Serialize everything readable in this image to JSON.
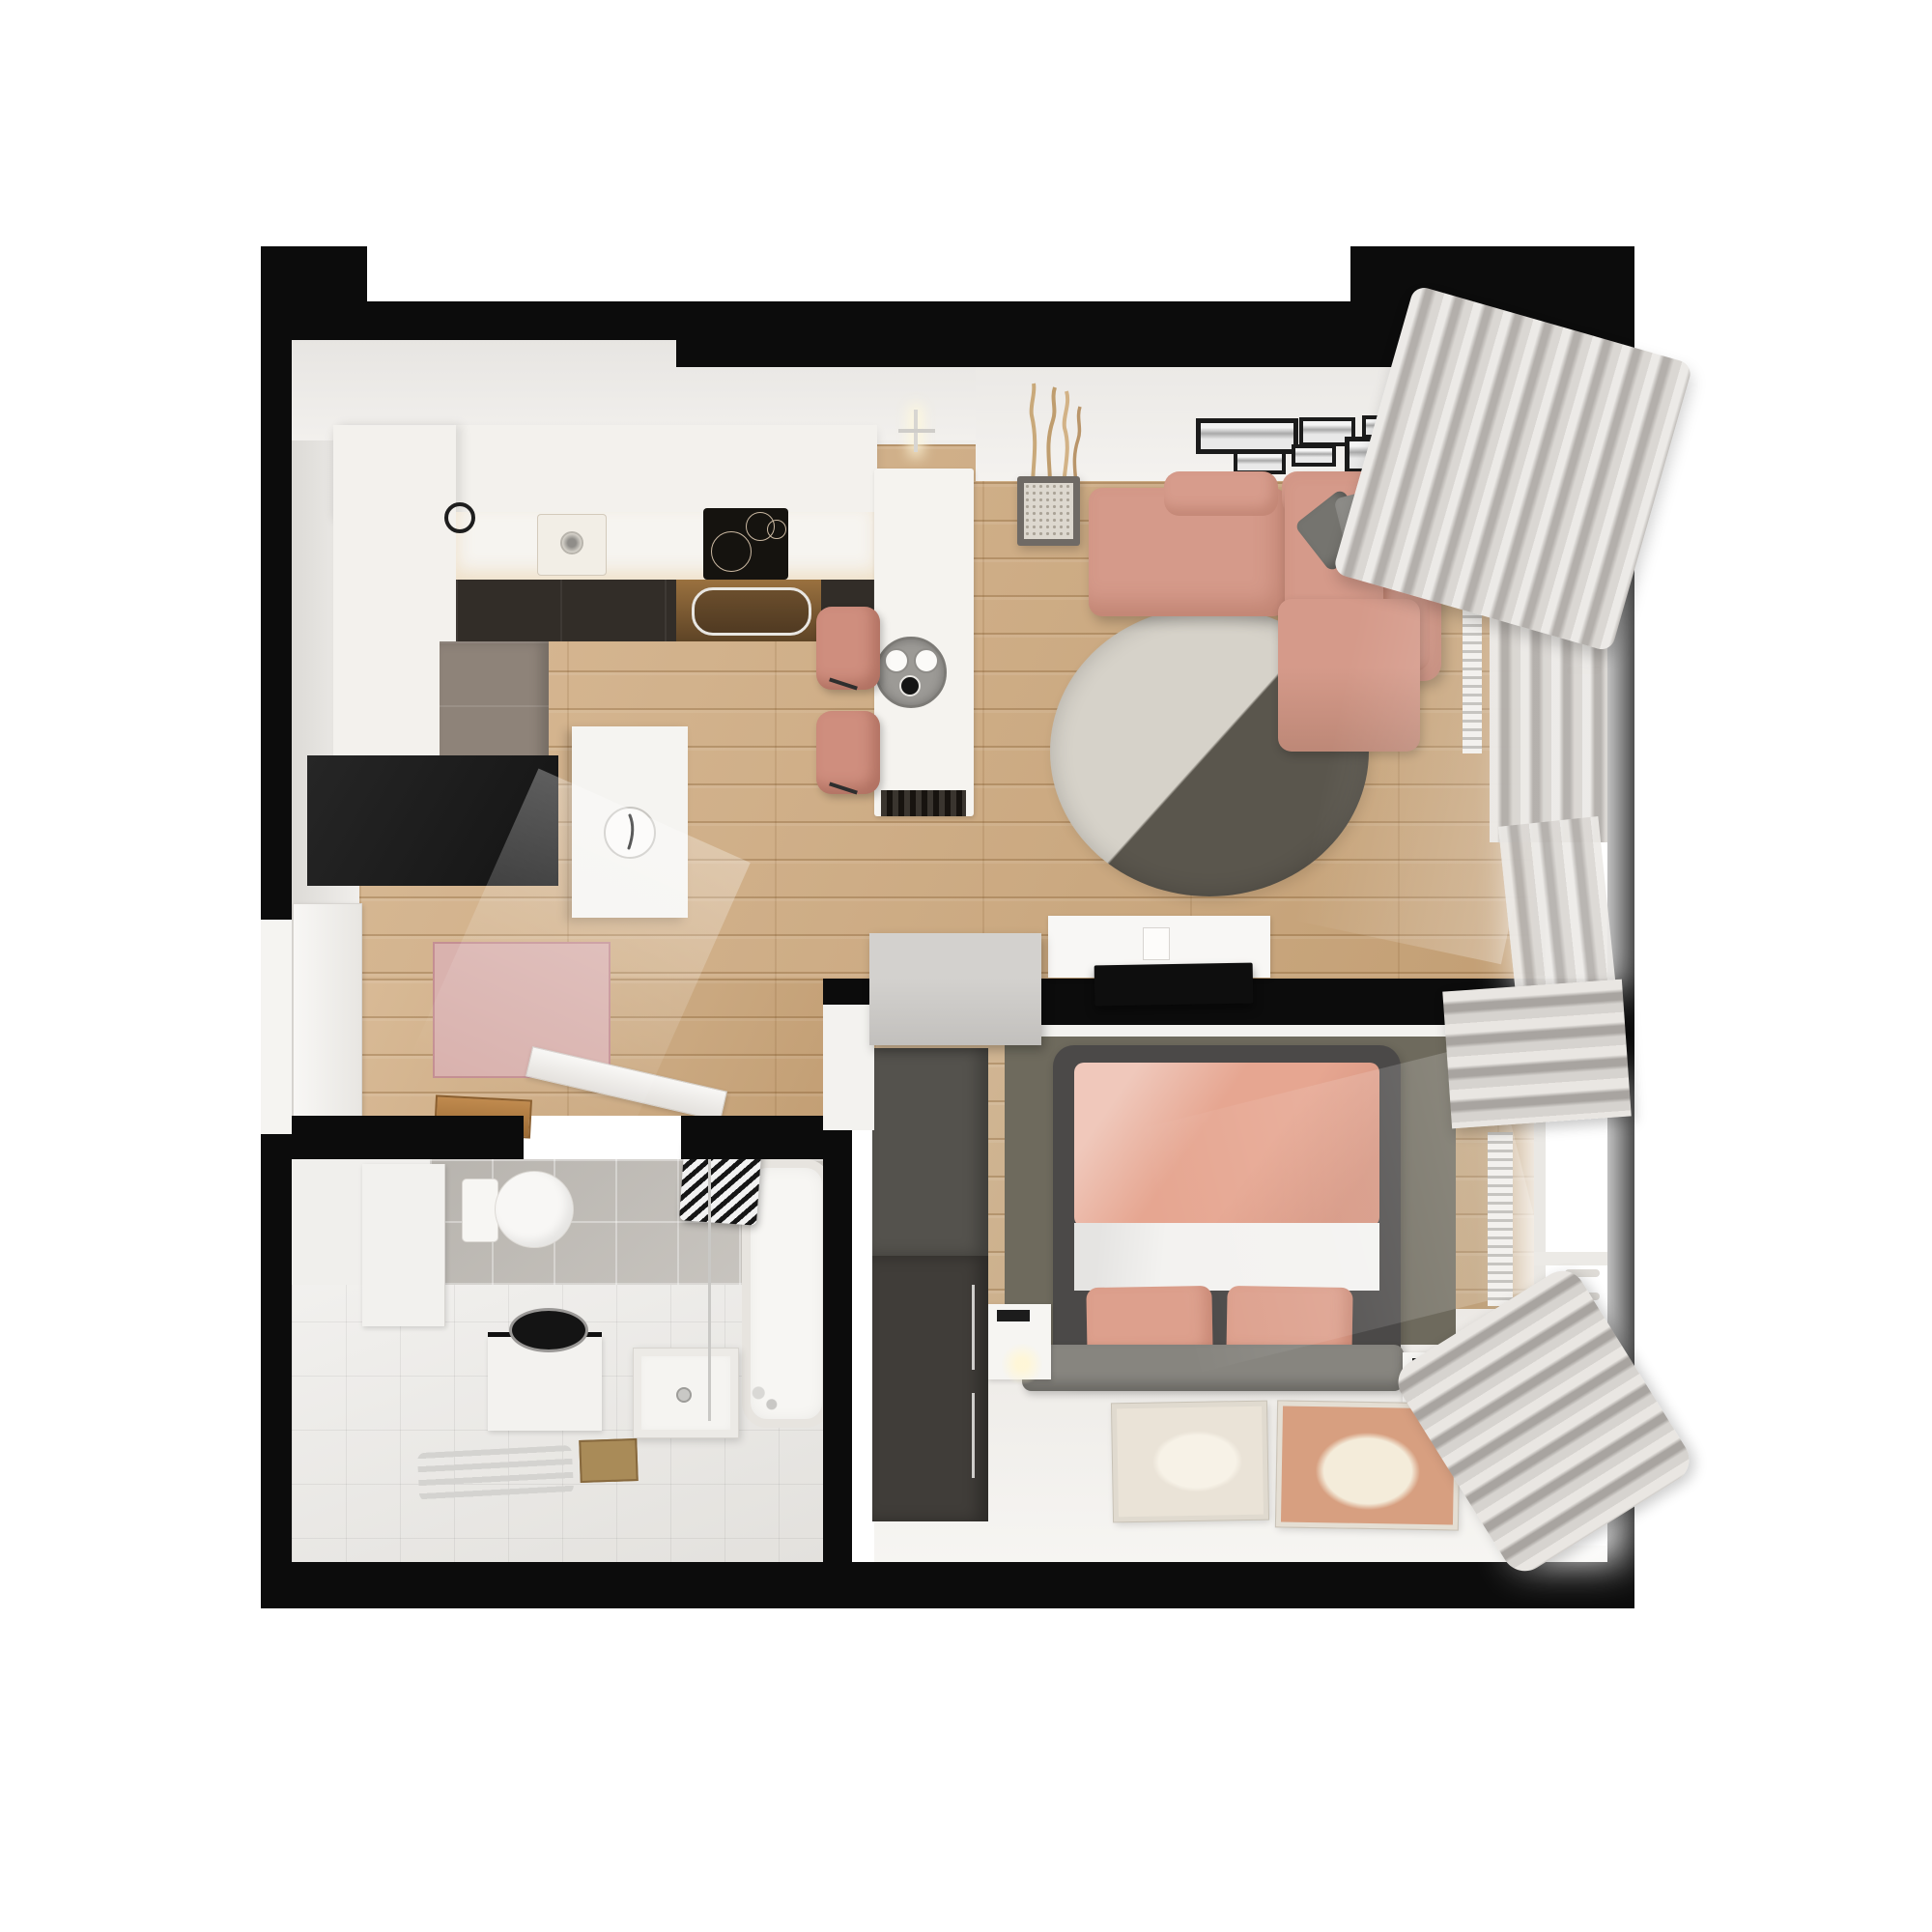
{
  "scene": {
    "type": "3d-rendered-floor-plan-top-view",
    "subject": "small one-bedroom apartment interior, photoreal top-down render",
    "background": "#ffffff",
    "no_visible_text": true
  },
  "palette": {
    "wall_black": "#0c0c0c",
    "inner_wall_white": "#efedea",
    "wood_floor": "#cfa97c",
    "wood_floor_bedroom": "#c9a87e",
    "counter_white": "#f6f4f0",
    "cabinet_white": "#f3f1ed",
    "cabinet_dark": "#322d28",
    "cabinet_taupe": "#8e8379",
    "island_white": "#f5f3ef",
    "vent_dark": "#24201c",
    "cooktop_black": "#15130f",
    "stool_pink": "#cf8e7e",
    "sofa_pink": "#d59a8a",
    "sofa_pink_shadow": "#bd8877",
    "pillow_gray_dark": "#75746f",
    "pillow_gray_light": "#8d8c88",
    "rug_light_half": "#d6d2c9",
    "rug_dark_half": "#5a564d",
    "planter_gray": "#6f6a65",
    "pebbles": "#ddd8cf",
    "branch_tan": "#c9a97a",
    "frame_black": "#1b1b1b",
    "tv_black": "#0e0e0e",
    "console_white": "#f8f7f5",
    "desk_gray": "#c9c7c4",
    "hall_wardrobe_black": "#191919",
    "clock_cabinet_white": "#f5f4f1",
    "hall_rug_pink": "#d9b2ae",
    "bath_floor_tile": "#eceae6",
    "bath_wall_tile": "#c3bfb9",
    "sanitary_white": "#f7f6f3",
    "chrome": "#c9c8c5",
    "basin_black": "#141414",
    "drain_wood": "#a98b58",
    "bedroom_rug_gray": "#6e6a5d",
    "bed_frame_gray": "#4b4948",
    "duvet_pink": "#e6a691",
    "sheet_white": "#f3f2f0",
    "pillow_pink": "#dda08d",
    "bench_gray": "#87857f",
    "wardrobe_top": "#54524d",
    "wardrobe_bottom": "#403d39",
    "nightstand_white": "#f6f5f2",
    "poster_beige": "#eae3d7",
    "poster_terracotta": "#d79f80",
    "curtain_gray": "#c7c3bf",
    "radiator_white": "#f0eeea",
    "window_glass": "#ffffff"
  },
  "rooms": {
    "kitchen": {
      "name": "kitchen",
      "items": [
        "L-shaped white cabinet run",
        "inset sink with faucet",
        "black induction cooktop",
        "dark base cabinets",
        "tall taupe cabinet",
        "white island bar with serving tray and two cups",
        "two pink upholstered bar stools",
        "island pendant lamp",
        "base vent grille"
      ]
    },
    "living_room": {
      "name": "living room",
      "items": [
        "pink L-shaped sectional sofa",
        "two gray throw pillows",
        "round two-tone rug (light/dark split)",
        "gallery wall of six black frames",
        "planter with dry branches",
        "white TV console with media box",
        "flat black TV",
        "gray wall desk",
        "window with gray curtains and radiator"
      ]
    },
    "hallway": {
      "name": "entry hallway",
      "items": [
        "black entry wardrobe",
        "white cabinet with round clock",
        "pink speckled rug",
        "open white entry door",
        "open bathroom door leaf",
        "wooden threshold mat"
      ]
    },
    "bathroom": {
      "name": "bathroom",
      "items": [
        "toilet",
        "round black countertop basin on white cabinet",
        "square white washbasin",
        "chrome towel radiator",
        "shower column",
        "bathtub with chrome faucet",
        "striped hanging towels",
        "gray tiled wall",
        "white floor tiles",
        "floor niche"
      ]
    },
    "bedroom": {
      "name": "bedroom",
      "items": [
        "double bed with dark gray frame",
        "pink duvet and white sheet",
        "two pink pillows",
        "gray foot bench",
        "textured gray rug",
        "two white nightstands with glowing lamps",
        "tall dark wardrobe",
        "two floor posters (beige and terracotta)",
        "window with roman shade, curtains and radiator"
      ]
    }
  }
}
